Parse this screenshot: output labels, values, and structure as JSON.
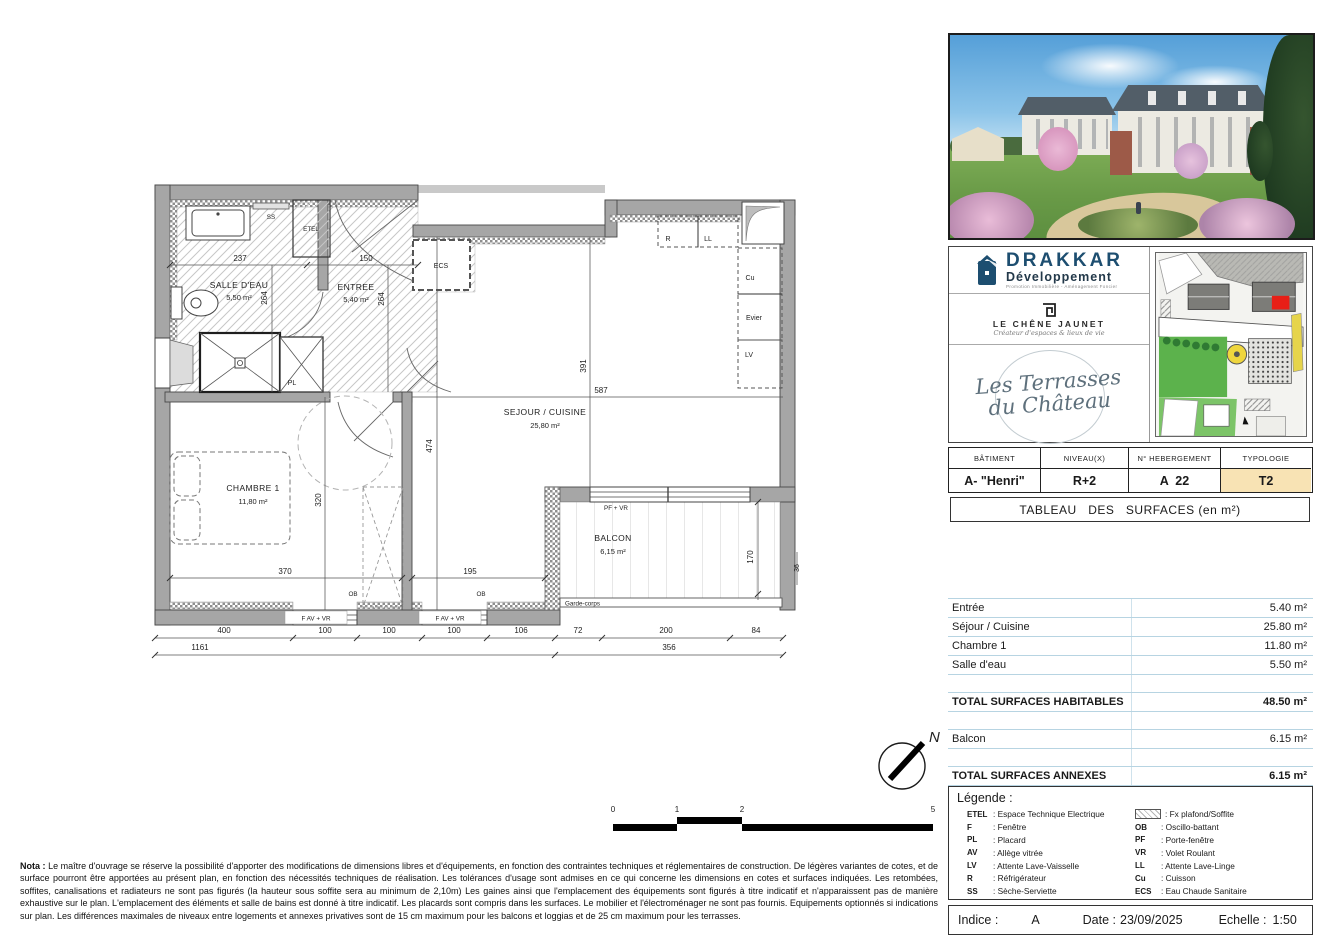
{
  "branding": {
    "drakkar_name": "DRAKKAR",
    "drakkar_sub": "Développement",
    "drakkar_tagline": "Promotion Immobilière  -  Aménagement Foncier",
    "chene_name": "LE CHÊNE JAUNET",
    "chene_tagline": "Créateur d'espaces & lieux de vie",
    "terrasses_line1": "Les Terrasses",
    "terrasses_line2": "du Château"
  },
  "unit": {
    "headers": [
      "BÂTIMENT",
      "NIVEAU(X)",
      "N° HEBERGEMENT",
      "TYPOLOGIE"
    ],
    "batiment": "A- \"Henri\"",
    "niveau": "R+2",
    "hebergement": "A  22",
    "typologie": "T2",
    "typologie_bg": "#f8e3b4"
  },
  "tableau_title": "TABLEAU   DES   SURFACES (en m²)",
  "surfaces": {
    "rows": [
      {
        "label": "Entrée",
        "value": "5.40 m²"
      },
      {
        "label": "Séjour / Cuisine",
        "value": "25.80 m²"
      },
      {
        "label": "Chambre 1",
        "value": "11.80 m²"
      },
      {
        "label": "Salle d'eau",
        "value": "5.50 m²"
      }
    ],
    "total_habitables_label": "TOTAL SURFACES HABITABLES",
    "total_habitables_value": "48.50 m²",
    "balcon_label": "Balcon",
    "balcon_value": "6.15 m²",
    "total_annexes_label": "TOTAL SURFACES ANNEXES",
    "total_annexes_value": "6.15 m²"
  },
  "legend": {
    "title": "Légende :",
    "left": [
      {
        "abbr": "ETEL",
        "label": ": Espace Technique Electrique"
      },
      {
        "abbr": "F",
        "label": ":  Fenêtre"
      },
      {
        "abbr": "PL",
        "label": ":  Placard"
      },
      {
        "abbr": "AV",
        "label": ":  Allège vitrée"
      },
      {
        "abbr": "LV",
        "label": ":  Attente Lave-Vaisselle"
      },
      {
        "abbr": "R",
        "label": ":  Réfrigérateur"
      },
      {
        "abbr": "SS",
        "label": ":  Sèche-Serviette"
      }
    ],
    "right": [
      {
        "abbr": "",
        "label": ": Fx plafond/Soffite"
      },
      {
        "abbr": "OB",
        "label": ":  Oscillo-battant"
      },
      {
        "abbr": "PF",
        "label": ":  Porte-fenêtre"
      },
      {
        "abbr": "VR",
        "label": ":  Volet Roulant"
      },
      {
        "abbr": "LL",
        "label": ":  Attente Lave-Linge"
      },
      {
        "abbr": "Cu",
        "label": ":  Cuisson"
      },
      {
        "abbr": "ECS",
        "label": ":  Eau Chaude Sanitaire"
      }
    ]
  },
  "footer": {
    "indice_label": "Indice :",
    "indice": "A",
    "date_label": "Date :",
    "date": "23/09/2025",
    "echelle_label": "Echelle :",
    "echelle": "1:50"
  },
  "nota": {
    "title": "Nota :",
    "body": "Le maître d'ouvrage se réserve la possibilité d'apporter des modifications de dimensions libres et d'équipements, en fonction des contraintes techniques et réglementaires de construction. De légères variantes de cotes, et de surface pourront être apportées au présent plan, en fonction des nécessités techniques de réalisation. Les tolérances d'usage sont admises en ce qui concerne les dimensions en cotes et surfaces indiquées. Les retombées, soffites, canalisations et radiateurs ne sont pas figurés (la hauteur sous soffite sera au minimum de 2,10m) Les gaines ainsi que l'emplacement des équipements sont figurés à titre indicatif et n'apparaissent pas de manière exhaustive sur le plan. L'emplacement des éléments et salle de bains est donné à titre indicatif. Les placards sont compris dans les surfaces. Le mobilier et l'électroménager ne sont pas fournis. Equipements optionnés si indications sur plan. Les différences maximales de niveaux entre logements et annexes privatives sont de 15 cm maximum pour les balcons et loggias et de 25 cm maximum pour les terrasses."
  },
  "scalebar": {
    "t0": "0",
    "t1": "1",
    "t2": "2",
    "t5": "5"
  },
  "compass": {
    "n": "N"
  },
  "plan": {
    "rooms": {
      "salle_deau": {
        "name": "SALLE D'EAU",
        "area": "5,50 m²"
      },
      "entree": {
        "name": "ENTREE",
        "area": "5,40 m²"
      },
      "sejour": {
        "name": "SEJOUR / CUISINE",
        "area": "25,80 m²"
      },
      "chambre": {
        "name": "CHAMBRE 1",
        "area": "11,80 m²"
      },
      "balcon": {
        "name": "BALCON",
        "area": "6,15 m²"
      }
    },
    "fixtures": {
      "ss": "SS",
      "etel": "ETEL",
      "ecs": "ECS",
      "pl": "PL",
      "r": "R",
      "ll": "LL",
      "cu": "Cu",
      "evier": "Evier",
      "lv": "LV",
      "ob1": "OB",
      "ob2": "OB",
      "pf_vr": "PF + VR",
      "f_av_vr_1": "F AV + VR",
      "f_av_vr_2": "F AV + VR",
      "garde_corps": "Garde-corps"
    },
    "dims": {
      "d237": "237",
      "d150": "150",
      "d264a": "264",
      "d264b": "264",
      "d391": "391",
      "d587": "587",
      "d474": "474",
      "d320": "320",
      "d370": "370",
      "d195": "195",
      "d170": "170",
      "d36": "36",
      "c400": "400",
      "c100a": "100",
      "c100b": "100",
      "c100c": "100",
      "c106": "106",
      "c72": "72",
      "c200": "200",
      "c84": "84",
      "c1161": "1161",
      "c356": "356"
    }
  }
}
